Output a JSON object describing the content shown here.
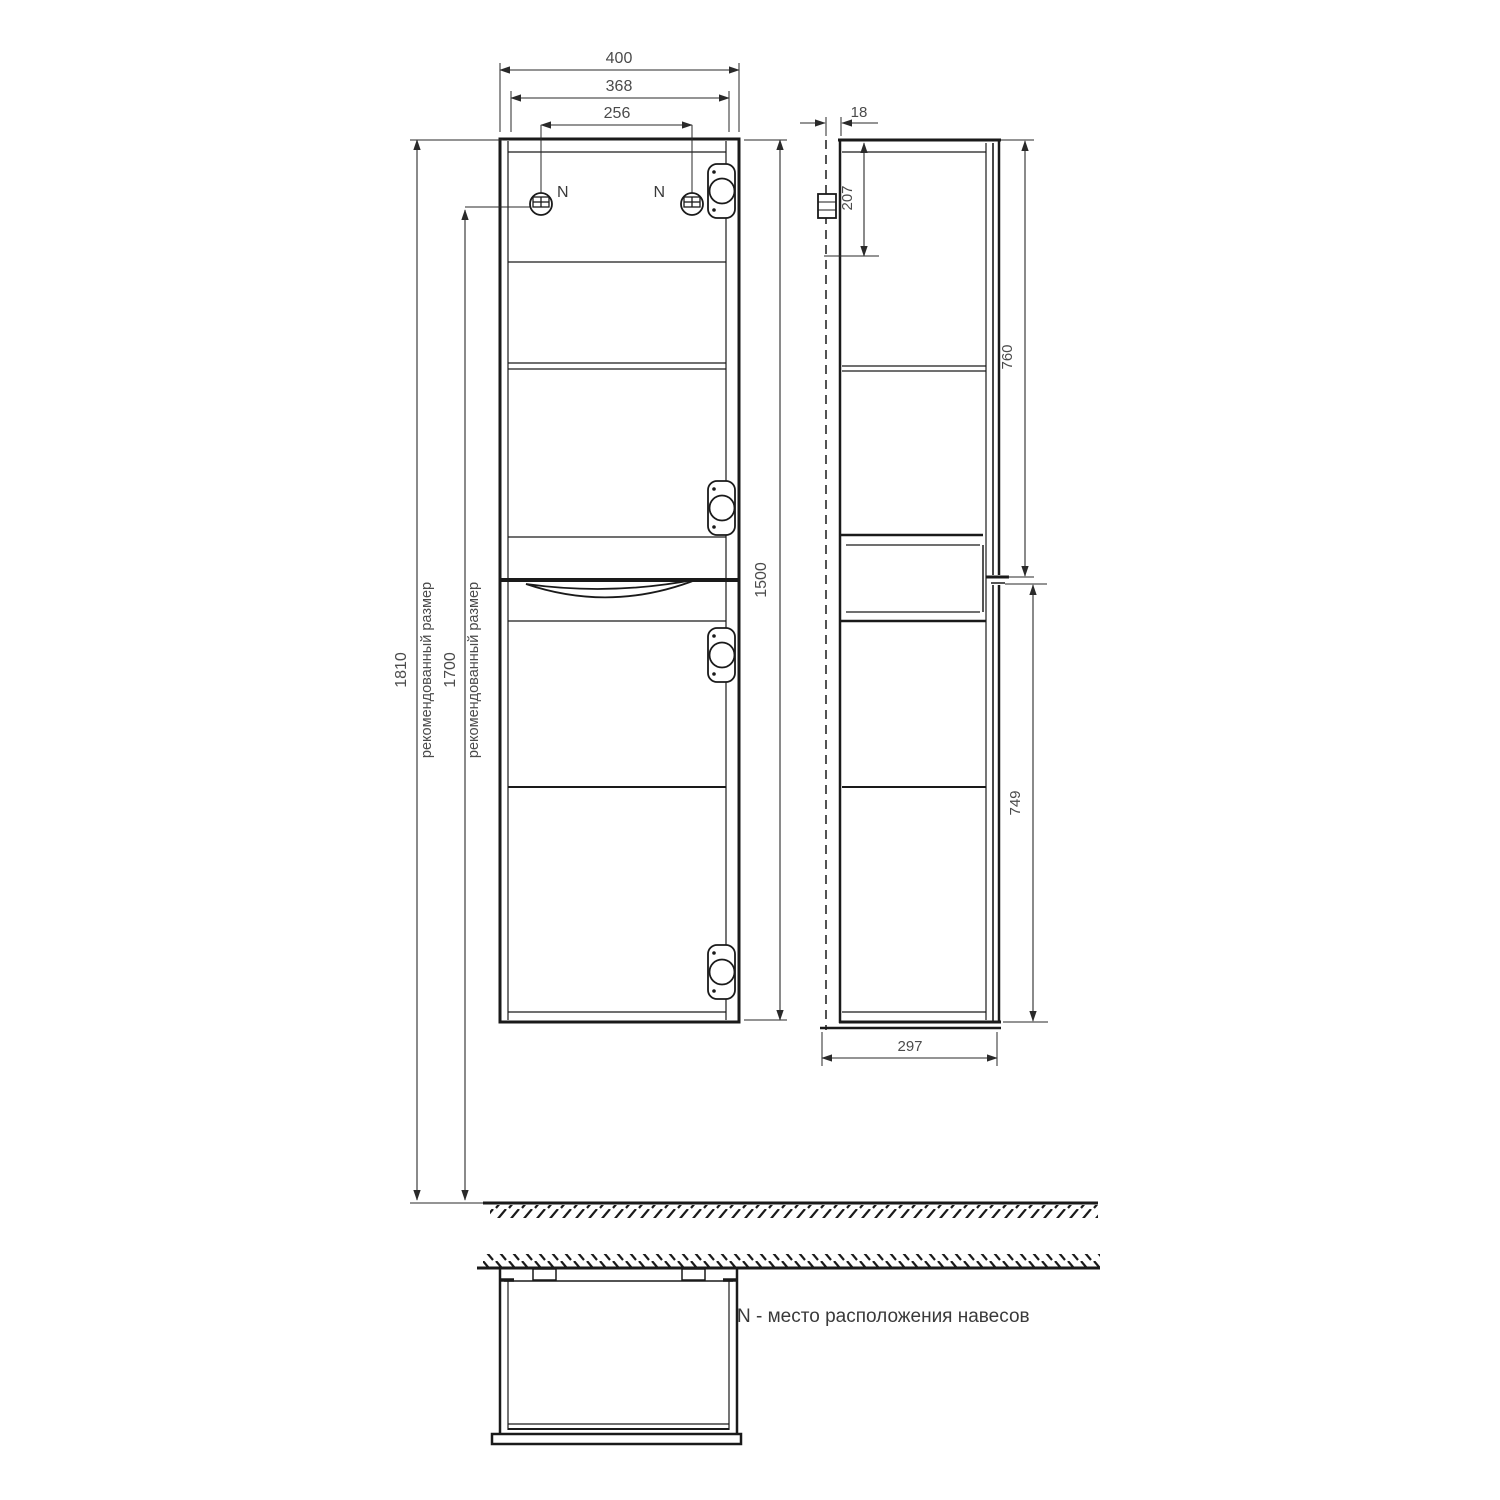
{
  "drawing": {
    "note": "N - место расположения навесов",
    "hanger_label_left": "N",
    "hanger_label_right": "N"
  },
  "front_view": {
    "dim_width_outer": "400",
    "dim_width_inner": "368",
    "dim_hanger_spacing": "256",
    "dim_height_recommended": "1810",
    "dim_height_recommended_label": "рекомендованный размер",
    "dim_height_hanger": "1700",
    "dim_height_hanger_label": "рекомендованный размер",
    "dim_height_cabinet": "1500"
  },
  "side_view": {
    "dim_wall_gap": "18",
    "dim_hanger_offset": "207",
    "dim_upper_section": "760",
    "dim_lower_section": "749",
    "dim_depth": "297"
  },
  "colors": {
    "line": "#1a1a1a",
    "dim_text": "#4b4b4b",
    "background": "#ffffff"
  }
}
